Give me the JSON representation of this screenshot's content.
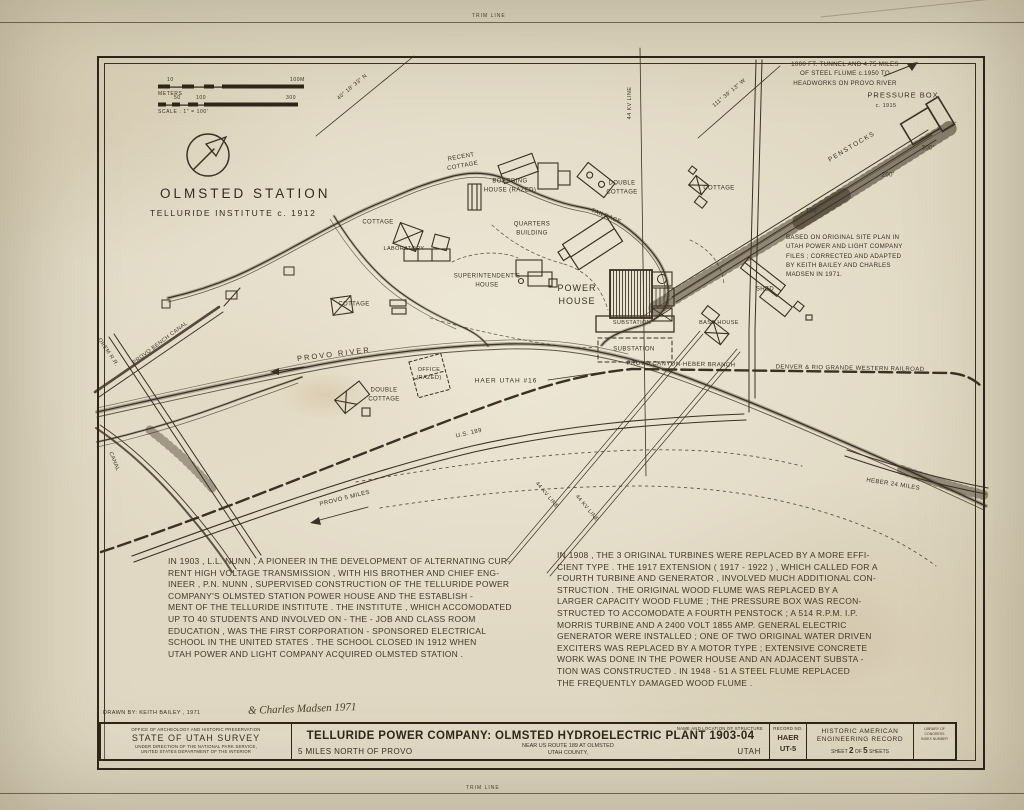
{
  "sheet": {
    "trim_top": "TRIM LINE",
    "trim_bottom": "TRIM LINE"
  },
  "map": {
    "title": "OLMSTED STATION",
    "subtitle": "TELLURIDE INSTITUTE c. 1912",
    "scale": {
      "m_left": "10",
      "m_right": "100M",
      "m_label": "METERS",
      "f1": "50",
      "f2": "100",
      "f3": "300",
      "ratio": "SCALE : 1\" = 100'"
    },
    "notes": {
      "tunnel": "1000 FT. TUNNEL AND 4.75 MILES\nOF STEEL FLUME c.1950 TO\nHEADWORKS ON PROVO RIVER",
      "source": "BASED ON ORIGINAL SITE PLAN IN\nUTAH POWER AND LIGHT COMPANY\nFILES ; CORRECTED AND ADAPTED\nBY KEITH BAILEY AND CHARLES\nMADSEN IN 1971."
    },
    "labels": [
      {
        "text": "RECENT\nCOTTAGE"
      },
      {
        "text": "BOARDING\nHOUSE (RAZED)"
      },
      {
        "text": "DOUBLE\nCOTTAGE"
      },
      {
        "text": "TAILRACE"
      },
      {
        "text": "QUARTERS\nBUILDING"
      },
      {
        "text": "COTTAGE"
      },
      {
        "text": "LABORATORY"
      },
      {
        "text": "SUPERINTENDENT'S\nHOUSE"
      },
      {
        "text": "COTTAGE"
      },
      {
        "text": "POWER\nHOUSE"
      },
      {
        "text": "SUBSTATION"
      },
      {
        "text": "SUBSTATION"
      },
      {
        "text": "SHED"
      },
      {
        "text": "BASE HOUSE"
      },
      {
        "text": "COTTAGE"
      },
      {
        "text": "PRESSURE BOX"
      },
      {
        "text": "c. 1915"
      },
      {
        "text": "PENSTOCKS"
      },
      {
        "text": "300'"
      },
      {
        "text": "200'"
      },
      {
        "text": "100'"
      },
      {
        "text": "44 KV LINE"
      },
      {
        "text": "44 KV LINE"
      },
      {
        "text": "44 KV LINE"
      },
      {
        "text": "PROVO RIVER"
      },
      {
        "text": "PROVO BENCH CANAL"
      },
      {
        "text": "OREM R.R."
      },
      {
        "text": "CANAL"
      },
      {
        "text": "OFFICE\n(RAZED)"
      },
      {
        "text": "DOUBLE\nCOTTAGE"
      },
      {
        "text": "HAER UTAH #16"
      },
      {
        "text": "U.S. 189"
      },
      {
        "text": "PROVO 5 MILES"
      },
      {
        "text": "HEBER 24 MILES"
      },
      {
        "text": "PROVO CANYON-HEBER BRANCH"
      },
      {
        "text": "DENVER & RIO GRANDE WESTERN RAILROAD"
      },
      {
        "text": "40° 18' 33\" N"
      },
      {
        "text": "111° 39' 13\" W"
      }
    ]
  },
  "history": {
    "left": "IN 1903 , L.L. NUNN , A PIONEER IN THE DEVELOPMENT OF ALTERNATING CUR-\nRENT HIGH VOLTAGE TRANSMISSION , WITH HIS BROTHER AND CHIEF ENG-\nINEER , P.N. NUNN , SUPERVISED CONSTRUCTION OF THE TELLURIDE POWER\nCOMPANY'S OLMSTED STATION POWER HOUSE AND THE ESTABLISH -\nMENT OF THE TELLURIDE INSTITUTE . THE INSTITUTE , WHICH ACCOMODATED\nUP TO 40 STUDENTS AND INVOLVED ON - THE - JOB AND CLASS ROOM\nEDUCATION , WAS THE FIRST CORPORATION - SPONSORED ELECTRICAL\nSCHOOL IN THE UNITED STATES . THE SCHOOL CLOSED IN 1912 WHEN\nUTAH POWER AND LIGHT COMPANY ACQUIRED OLMSTED STATION .",
    "right": "IN 1908 , THE 3 ORIGINAL TURBINES WERE REPLACED BY A MORE EFFI-\nCIENT TYPE . THE 1917 EXTENSION ( 1917 - 1922 ) , WHICH CALLED FOR A\nFOURTH TURBINE AND GENERATOR , INVOLVED MUCH ADDITIONAL CON-\nSTRUCTION . THE ORIGINAL WOOD FLUME WAS REPLACED BY A\nLARGER CAPACITY WOOD FLUME ; THE PRESSURE BOX WAS RECON-\nSTRUCTED TO ACCOMODATE A FOURTH PENSTOCK ; A 514 R.P.M. I.P.\nMORRIS TURBINE AND A 2400 VOLT 1855 AMP. GENERAL ELECTRIC\nGENERATOR WERE INSTALLED ; ONE OF TWO ORIGINAL WATER DRIVEN\nEXCITERS WAS REPLACED BY A MOTOR TYPE ; EXTENSIVE CONCRETE\nWORK WAS DONE IN THE POWER HOUSE AND AN ADJACENT SUBSTA -\nTION WAS CONSTRUCTED . IN 1948 - 51 A STEEL FLUME REPLACED\nTHE FREQUENTLY DAMAGED WOOD FLUME ."
  },
  "titleblock": {
    "drawn_by": "DRAWN BY: KEITH BAILEY , 1971",
    "drawn_by_script": "& Charles Madsen  1971",
    "agency_top": "OFFICE OF ARCHEOLOGY AND HISTORIC PRESERVATION",
    "agency_main": "STATE OF UTAH SURVEY",
    "agency_sub": "UNDER DIRECTION OF THE NATIONAL PARK SERVICE,\nUNITED STATES DEPARTMENT OF THE INTERIOR",
    "name_caption": "NAME AND LOCATION OF STRUCTURE",
    "structure": "TELLURIDE POWER COMPANY: OLMSTED HYDROELECTRIC PLANT 1903-04",
    "loc_left": "5 MILES NORTH OF PROVO",
    "loc_mid": "NEAR US ROUTE 189 AT OLMSTED\nUTAH COUNTY,",
    "loc_state": "UTAH",
    "record_caption": "RECORD NO.",
    "record_line1": "HAER",
    "record_line2": "UT-5",
    "org_line1": "HISTORIC AMERICAN",
    "org_line2": "ENGINEERING RECORD",
    "sheet_prefix": "SHEET",
    "sheet_no": "2",
    "sheet_of": "OF",
    "sheet_total": "5",
    "sheet_suffix": "SHEETS",
    "loc_box": "LIBRARY OF CONGRESS\nINDEX NUMBER"
  }
}
